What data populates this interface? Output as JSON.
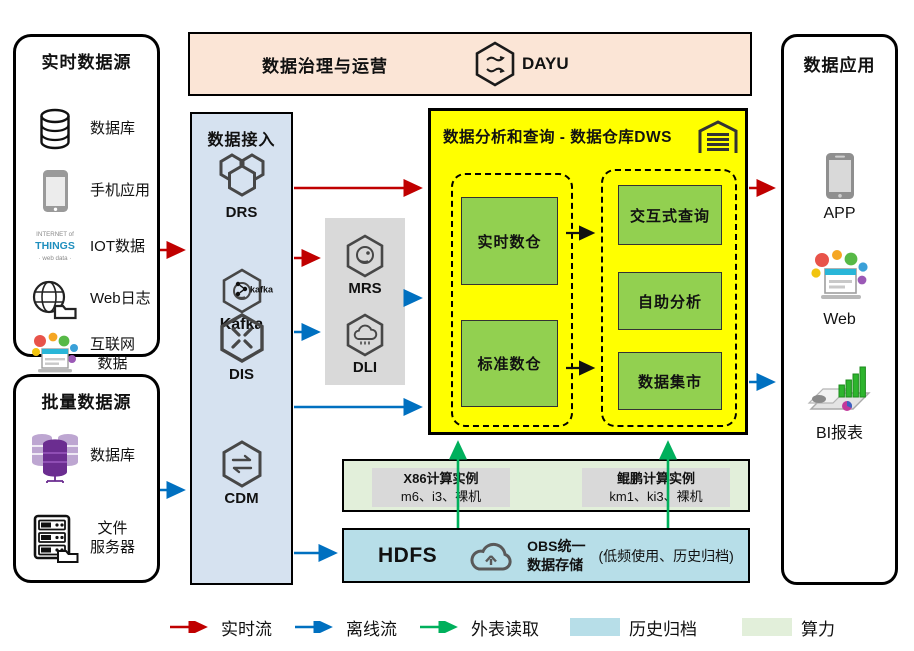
{
  "colors": {
    "realtime_flow": "#c00000",
    "offline_flow": "#0070c0",
    "external_read": "#00b05c",
    "archive_fill": "#b7dee8",
    "compute_fill": "#e2efda",
    "dws_fill": "#ffff00",
    "warehouse_green": "#92d050",
    "governance_fill": "#fbe5d6",
    "ingestion_fill": "#d6e2f0",
    "processing_fill": "#d9d9d9"
  },
  "realtime_sources": {
    "title": "实时数据源",
    "items": [
      {
        "label": "数据库",
        "icon": "database-icon"
      },
      {
        "label": "手机应用",
        "icon": "mobile-phone-icon"
      },
      {
        "label": "IOT数据",
        "icon": "iot-wordcloud-icon",
        "icon_text_line1": "INTERNET of",
        "icon_text_line2": "THINGS"
      },
      {
        "label": "Web日志",
        "icon": "web-log-icon"
      },
      {
        "label_line1": "互联网",
        "label_line2": "数据",
        "icon": "internet-data-icon"
      }
    ]
  },
  "batch_sources": {
    "title": "批量数据源",
    "items": [
      {
        "label": "数据库",
        "icon": "purple-database-icon"
      },
      {
        "label_line1": "文件",
        "label_line2": "服务器",
        "icon": "file-server-icon"
      }
    ]
  },
  "governance": {
    "title": "数据治理与运营",
    "product": "DAYU"
  },
  "ingestion": {
    "title": "数据接入",
    "items": [
      {
        "label": "DRS"
      },
      {
        "label": "Kafka",
        "badge": "kafka"
      },
      {
        "label": "DIS"
      },
      {
        "label": "CDM"
      }
    ]
  },
  "processing": {
    "items": [
      {
        "label": "MRS"
      },
      {
        "label": "DLI"
      }
    ]
  },
  "dws": {
    "title": "数据分析和查询 - 数据仓库DWS",
    "warehouses": [
      {
        "label": "实时数仓"
      },
      {
        "label": "标准数仓"
      }
    ],
    "services": [
      {
        "label": "交互式查询"
      },
      {
        "label": "自助分析"
      },
      {
        "label": "数据集市"
      }
    ]
  },
  "compute": {
    "instances": [
      {
        "title": "X86计算实例",
        "detail": "m6、i3、裸机"
      },
      {
        "title": "鲲鹏计算实例",
        "detail": "km1、ki3、裸机"
      }
    ]
  },
  "storage": {
    "hdfs_label": "HDFS",
    "obs_line1": "OBS统一",
    "obs_line2": "数据存储",
    "note": "(低频使用、历史归档)"
  },
  "applications": {
    "title": "数据应用",
    "items": [
      {
        "label": "APP",
        "icon": "app-phone-icon"
      },
      {
        "label": "Web",
        "icon": "web-collage-icon"
      },
      {
        "label": "BI报表",
        "icon": "bi-report-icon"
      }
    ]
  },
  "legend": {
    "items": [
      {
        "kind": "arrow",
        "label": "实时流",
        "color": "#c00000"
      },
      {
        "kind": "arrow",
        "label": "离线流",
        "color": "#0070c0"
      },
      {
        "kind": "arrow",
        "label": "外表读取",
        "color": "#00b05c"
      },
      {
        "kind": "swatch",
        "label": "历史归档",
        "color": "#b7dee8"
      },
      {
        "kind": "swatch",
        "label": "算力",
        "color": "#e2efda"
      }
    ]
  }
}
